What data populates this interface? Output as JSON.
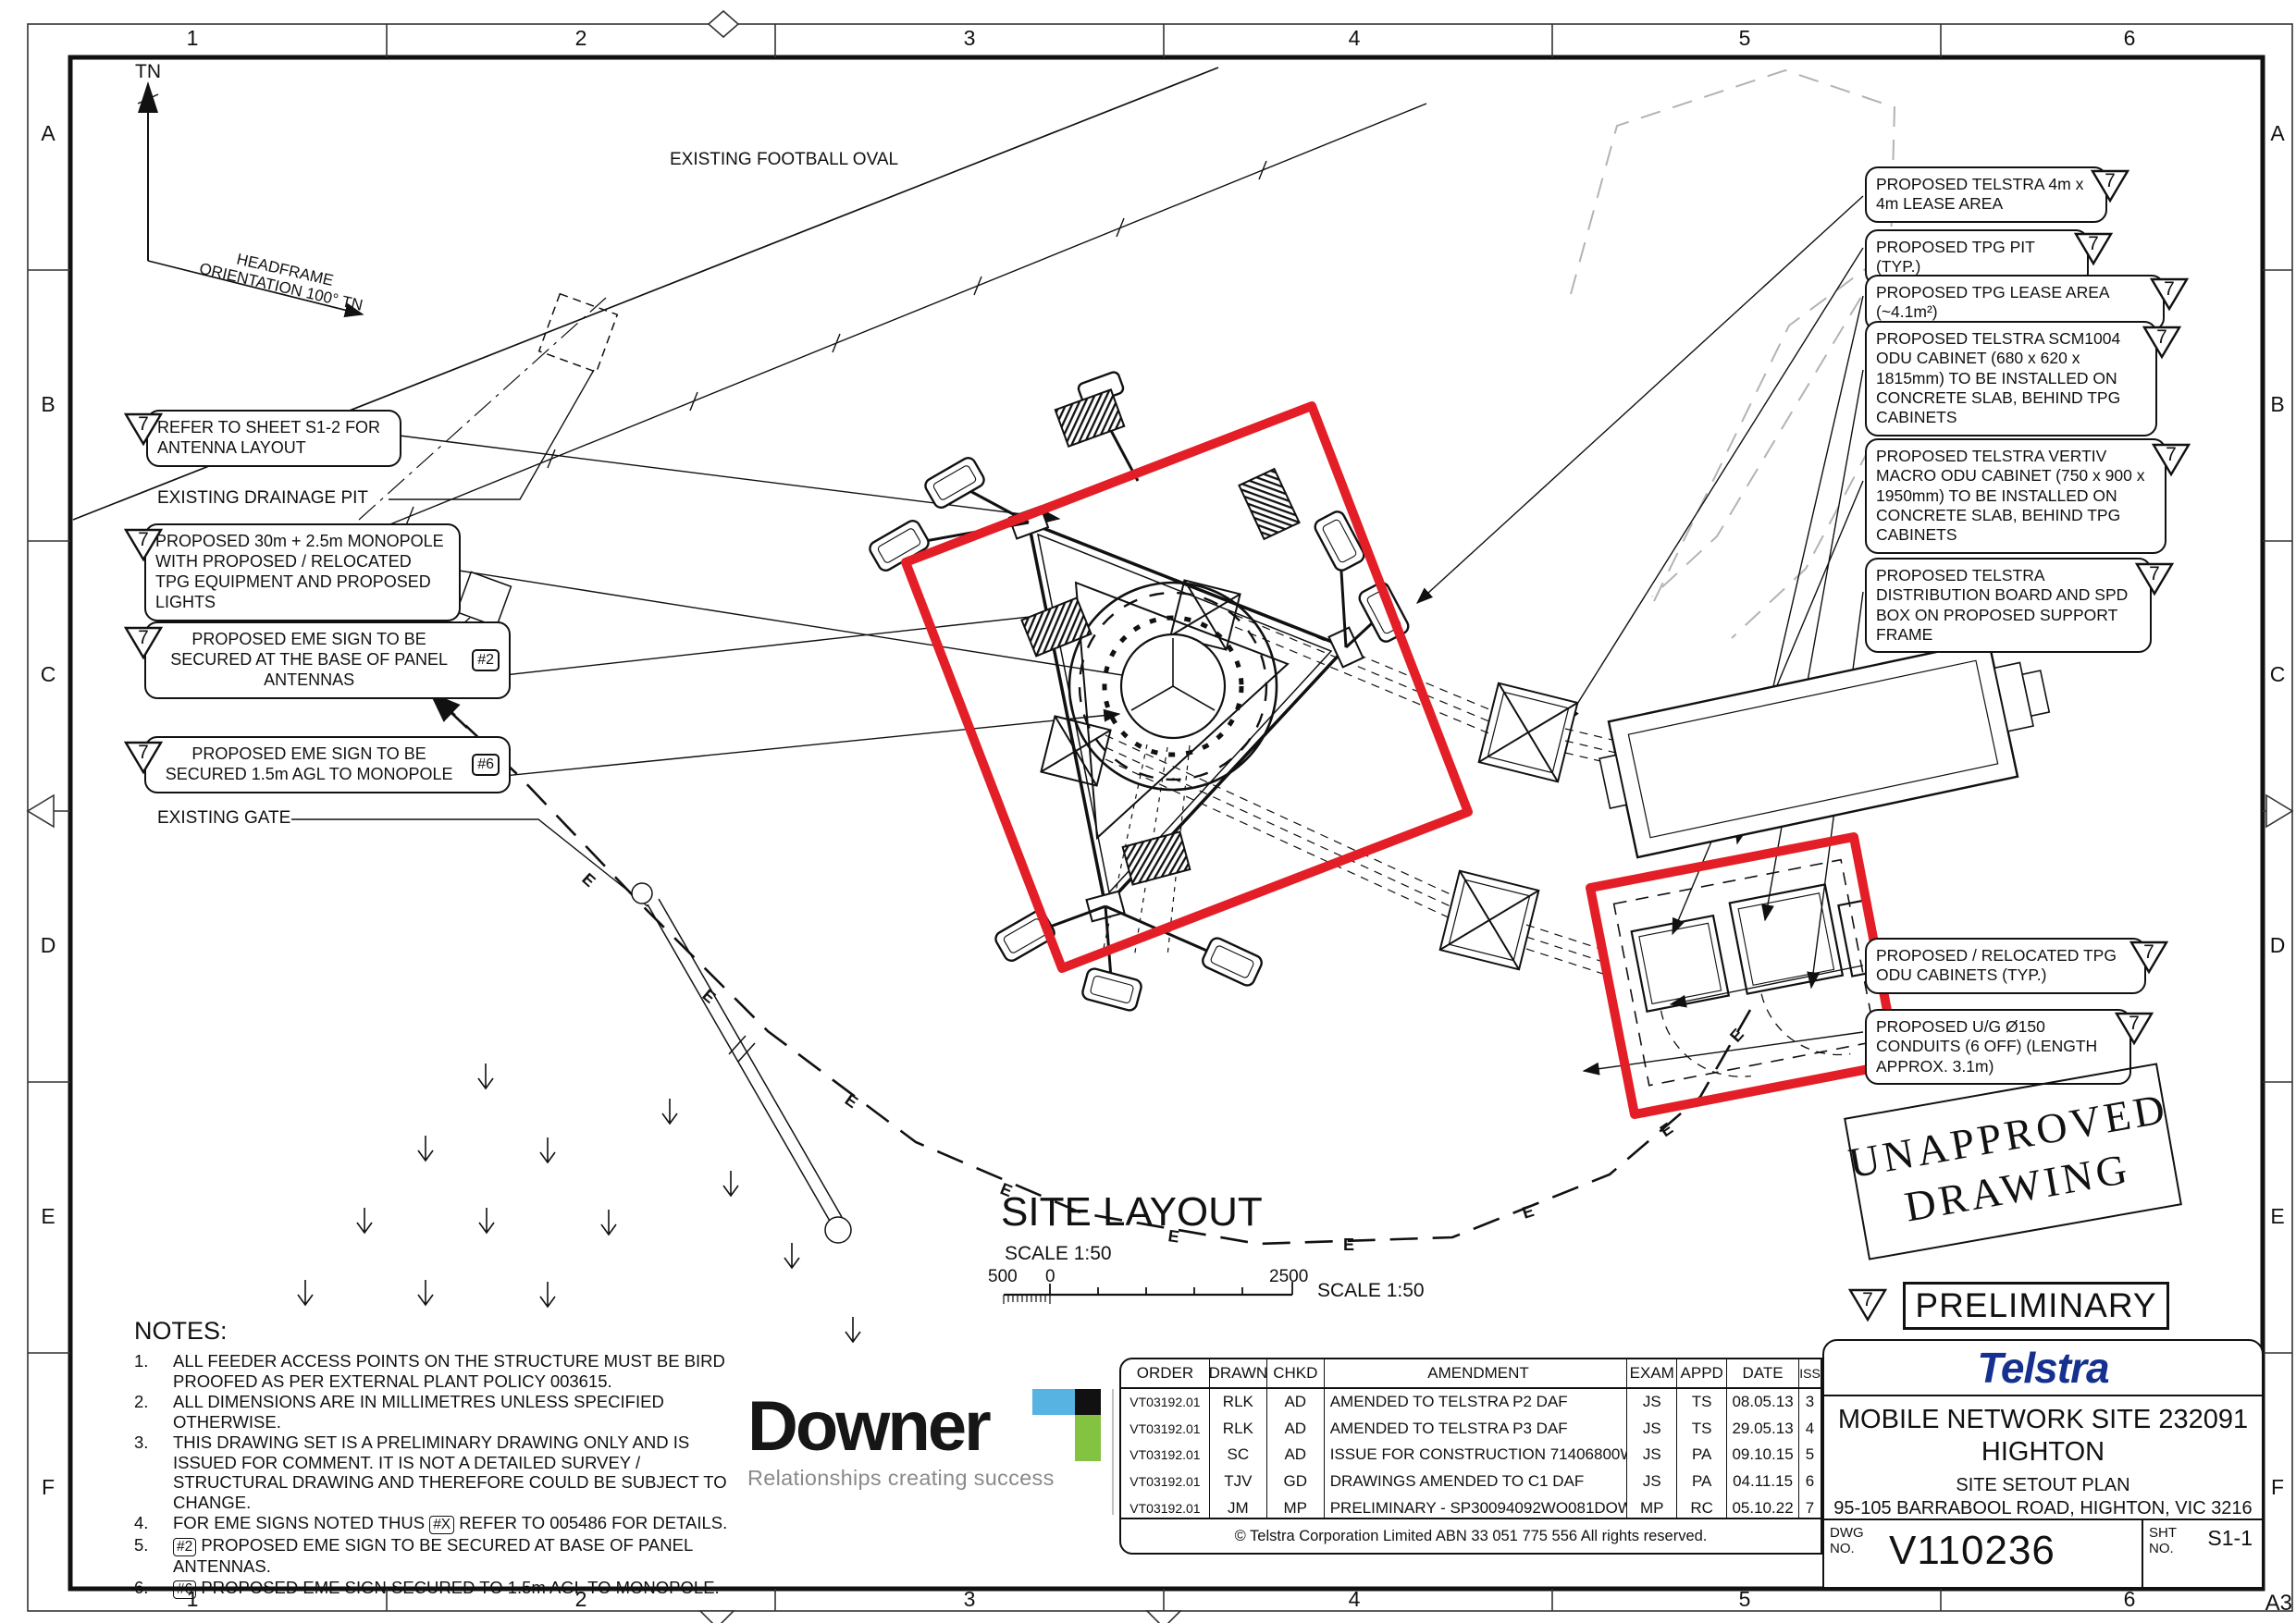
{
  "grid": {
    "cols": [
      "1",
      "2",
      "3",
      "4",
      "5",
      "6"
    ],
    "rows": [
      "A",
      "B",
      "C",
      "D",
      "E",
      "F"
    ],
    "sheet_size": "A3"
  },
  "compass": {
    "tn": "TN",
    "headframe_line1": "HEADFRAME",
    "headframe_line2": "ORIENTATION 100° TN"
  },
  "drawing_labels": {
    "football_oval": "EXISTING FOOTBALL OVAL",
    "drainage_pit": "EXISTING DRAINAGE PIT",
    "existing_gate": "EXISTING GATE"
  },
  "callouts_left": [
    {
      "text": "REFER TO SHEET S1-2 FOR ANTENNA LAYOUT",
      "marker": "7"
    },
    {
      "text": "PROPOSED 30m + 2.5m MONOPOLE WITH PROPOSED / RELOCATED TPG EQUIPMENT AND PROPOSED LIGHTS",
      "marker": "7"
    },
    {
      "text": "PROPOSED EME SIGN TO BE SECURED AT THE BASE OF PANEL ANTENNAS",
      "tag": "#2",
      "marker": "7"
    },
    {
      "text": "PROPOSED EME SIGN TO BE SECURED 1.5m AGL TO MONOPOLE",
      "tag": "#6",
      "marker": "7"
    }
  ],
  "callouts_right": [
    {
      "text": "PROPOSED TELSTRA 4m x 4m LEASE AREA",
      "marker": "7"
    },
    {
      "text": "PROPOSED TPG PIT (TYP.)",
      "marker": "7"
    },
    {
      "text": "PROPOSED TPG LEASE AREA (~4.1m²)",
      "marker": "7"
    },
    {
      "text": "PROPOSED TELSTRA SCM1004 ODU CABINET (680 x 620 x 1815mm) TO BE INSTALLED ON CONCRETE SLAB, BEHIND TPG CABINETS",
      "marker": "7"
    },
    {
      "text": "PROPOSED TELSTRA VERTIV MACRO ODU CABINET (750 x 900 x 1950mm) TO BE INSTALLED ON CONCRETE SLAB, BEHIND TPG CABINETS",
      "marker": "7"
    },
    {
      "text": "PROPOSED TELSTRA DISTRIBUTION BOARD AND SPD BOX ON PROPOSED SUPPORT FRAME",
      "marker": "7"
    },
    {
      "text": "PROPOSED / RELOCATED TPG ODU CABINETS (TYP.)",
      "marker": "7"
    },
    {
      "text": "PROPOSED U/G Ø150 CONDUITS (6 OFF) (LENGTH APPROX. 3.1m)",
      "marker": "7"
    }
  ],
  "stamps": {
    "rev": "7",
    "unapproved_line1": "UNAPPROVED",
    "unapproved_line2": "DRAWING",
    "preliminary": "PRELIMINARY"
  },
  "site_layout": {
    "title": "SITE LAYOUT",
    "scale": "SCALE 1:50",
    "bar_left": "500",
    "bar_zero": "0",
    "bar_right": "2500",
    "scale_note": "SCALE 1:50"
  },
  "misc": {
    "e_label": "E"
  },
  "notes": {
    "title": "NOTES:",
    "items": [
      {
        "num": "1.",
        "text": "ALL FEEDER ACCESS POINTS ON THE STRUCTURE MUST BE BIRD PROOFED AS PER EXTERNAL PLANT POLICY 003615."
      },
      {
        "num": "2.",
        "text": "ALL DIMENSIONS ARE IN MILLIMETRES UNLESS SPECIFIED OTHERWISE."
      },
      {
        "num": "3.",
        "text": "THIS DRAWING SET IS A PRELIMINARY DRAWING ONLY AND IS ISSUED FOR COMMENT. IT IS NOT A DETAILED SURVEY / STRUCTURAL DRAWING AND THEREFORE COULD BE SUBJECT TO CHANGE."
      },
      {
        "num": "4.",
        "pre": "FOR EME SIGNS NOTED THUS",
        "tag": "#X",
        "post": "REFER TO 005486 FOR DETAILS."
      },
      {
        "num": "5.",
        "tag": "#2",
        "post": "PROPOSED EME SIGN TO BE SECURED AT BASE OF PANEL ANTENNAS."
      },
      {
        "num": "6.",
        "tag": "#6",
        "post": "PROPOSED EME SIGN SECURED TO 1.5m AGL TO MONOPOLE."
      }
    ]
  },
  "downer": {
    "name": "Downer",
    "tagline": "Relationships creating success"
  },
  "revisions": {
    "headers": [
      "ORDER",
      "DRAWN",
      "CHKD",
      "AMENDMENT",
      "EXAM",
      "APPD",
      "DATE",
      "ISS"
    ],
    "rows": [
      [
        "VT03192.01",
        "RLK",
        "AD",
        "AMENDED TO TELSTRA P2 DAF",
        "JS",
        "TS",
        "08.05.13",
        "3"
      ],
      [
        "VT03192.01",
        "RLK",
        "AD",
        "AMENDED TO TELSTRA P3 DAF",
        "JS",
        "TS",
        "29.05.13",
        "4"
      ],
      [
        "VT03192.01",
        "SC",
        "AD",
        "ISSUE FOR CONSTRUCTION 71406800WO03AA",
        "JS",
        "PA",
        "09.10.15",
        "5"
      ],
      [
        "VT03192.01",
        "TJV",
        "GD",
        "DRAWINGS AMENDED TO C1 DAF",
        "JS",
        "PA",
        "04.11.15",
        "6"
      ],
      [
        "VT03192.01",
        "JM",
        "MP",
        "PRELIMINARY - SP30094092WO081DOWN",
        "MP",
        "RC",
        "05.10.22",
        "7"
      ]
    ],
    "copyright": "© Telstra Corporation Limited ABN 33 051 775 556   All rights reserved."
  },
  "title_block": {
    "brand": "Telstra",
    "site": "MOBILE NETWORK SITE 232091",
    "locality": "HIGHTON",
    "plan": "SITE SETOUT PLAN",
    "address": "95-105 BARRABOOL ROAD, HIGHTON, VIC 3216",
    "dwg_label_1": "DWG",
    "dwg_label_2": "NO.",
    "dwg_no": "V110236",
    "sht_label_1": "SHT",
    "sht_label_2": "NO.",
    "sht_no": "S1-1"
  },
  "colors": {
    "red": "#e31e26",
    "telstra_blue": "#15308f",
    "telstra_cyan": "#25a7e0",
    "downer_blue": "#56b3e2",
    "downer_green": "#84c341"
  }
}
